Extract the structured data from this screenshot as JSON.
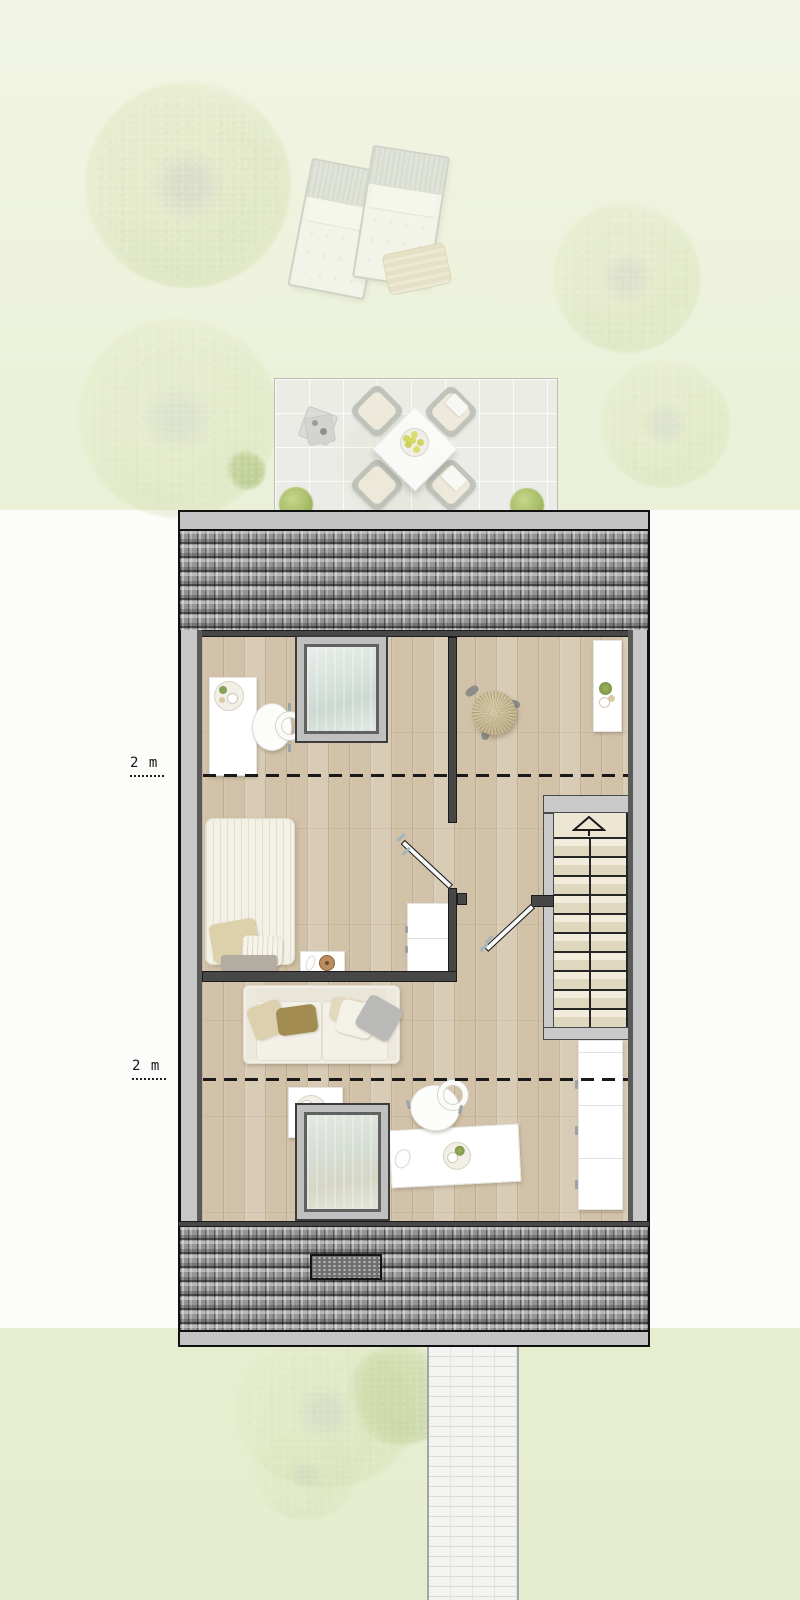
{
  "meta": {
    "type": "architectural-floor-plan",
    "view": "top-down attic storey with garden, terrace and roof"
  },
  "annotations": {
    "headroom_1": "2 m",
    "headroom_2": "2 m"
  },
  "palette": {
    "garden_green": "#ebf1d8",
    "plan_paper_white": "#fcfcfa",
    "roof_tile_gray": "#9e9e9e",
    "eave_gray": "#c4c4c4",
    "wall_dark": "#474747",
    "wall_light": "#c8c8c8",
    "wood_floor": "#d6c8b0",
    "skylight_glass": "#d6e0da",
    "stair_cream": "#ede6d3",
    "sofa_cream": "#f1eee5",
    "pillow_olive": "#a38c52",
    "pillow_tan": "#ddd1ab",
    "rattan_tan": "#c0b088",
    "plant_green": "#83a258",
    "bush_green": "#a8bd69",
    "fruit_yellow": "#d4d84f",
    "path_white": "#f3f3f1"
  },
  "legend": [
    "garden trees",
    "sun loungers",
    "terrace with dining set",
    "potted bushes",
    "tiled roof with vent",
    "skylight windows",
    "desk with office chair",
    "rattan stool",
    "wall shelf",
    "single bed with nightstand",
    "cabinet",
    "sofa with pillows",
    "staircase with up arrow",
    "interior doors",
    "side table",
    "wardrobe",
    "garden path",
    "2 m headroom dashed lines"
  ]
}
